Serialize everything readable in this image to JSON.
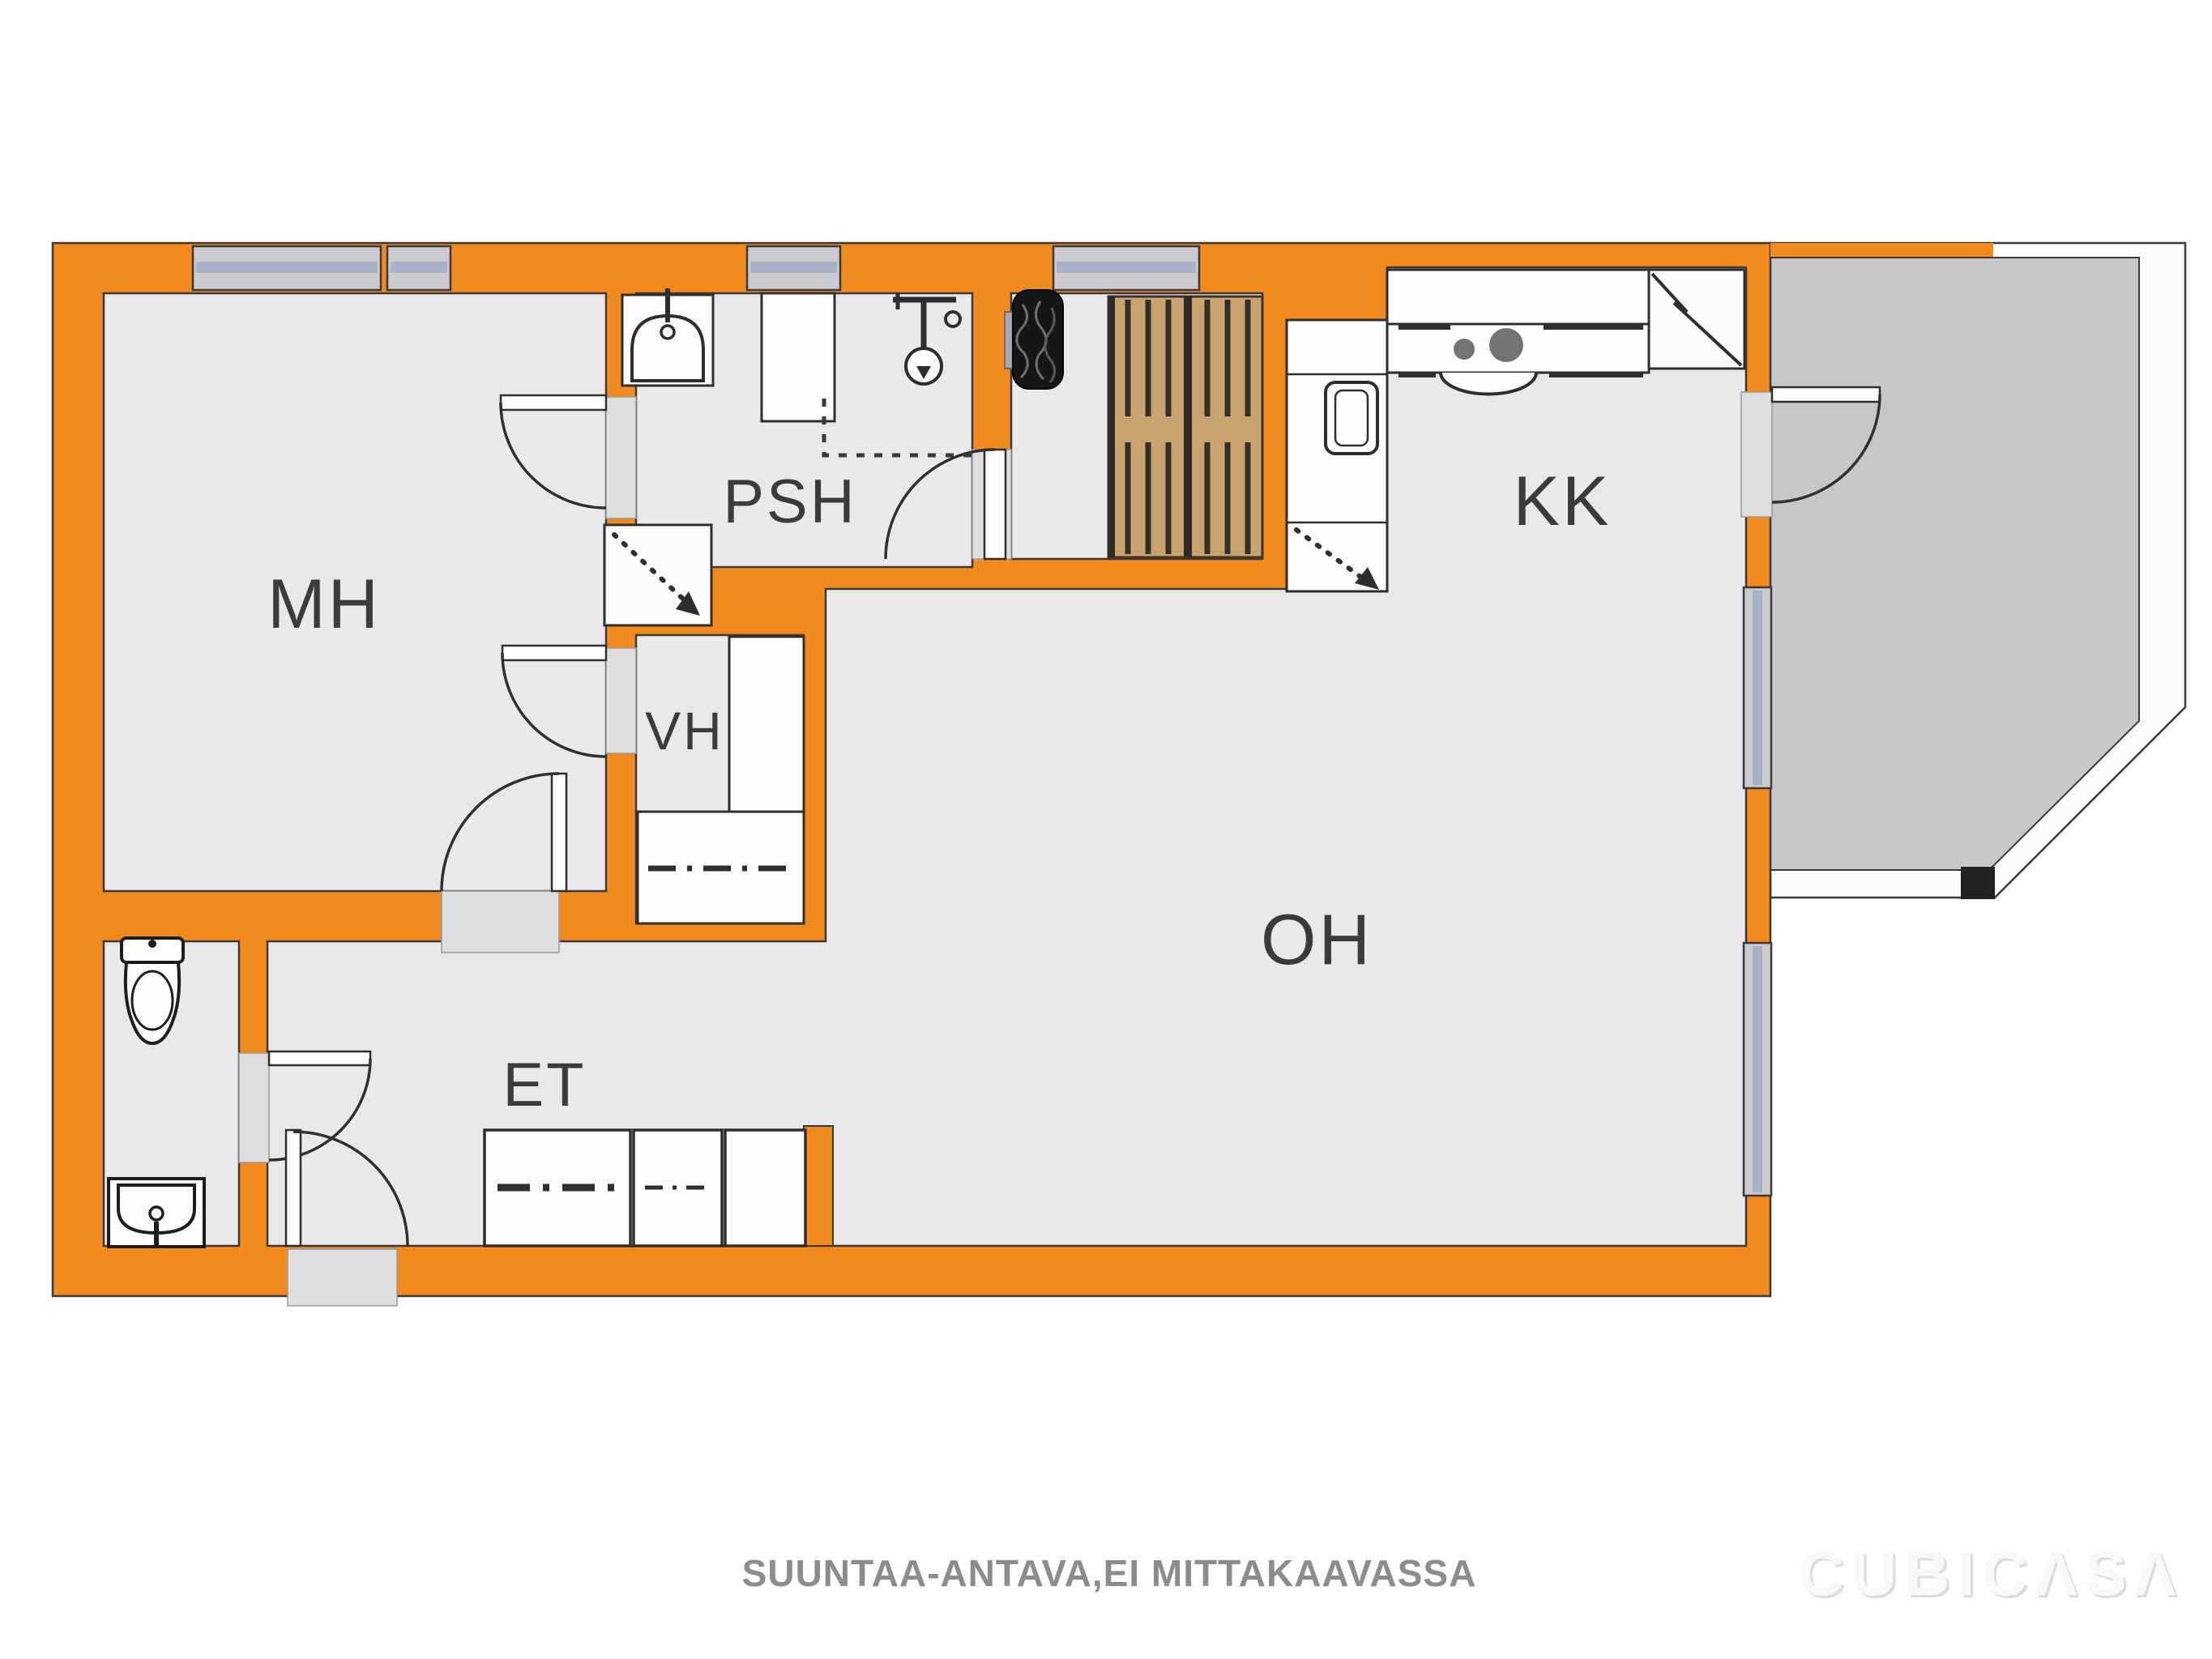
{
  "plan": {
    "rooms": {
      "mh": {
        "label": "MH"
      },
      "psh": {
        "label": "PSH"
      },
      "vh": {
        "label": "VH"
      },
      "kk": {
        "label": "KK"
      },
      "oh": {
        "label": "OH"
      },
      "et": {
        "label": "ET"
      }
    }
  },
  "footer": {
    "disclaimer": "SUUNTAA-ANTAVA,EI MITTAKAAVASSA"
  },
  "branding": {
    "logo_text": "CUBICΛSΛ"
  },
  "icons": {
    "toilet": "toilet-icon",
    "sink": "sink-icon",
    "shower": "shower-icon",
    "sauna_stove": "sauna-stove-icon",
    "stove_burners": "stove-burners-icon",
    "fridge": "fridge-zigzag-icon",
    "oven": "oven-icon",
    "wardrobe": "wardrobe-dashdot-icon"
  },
  "colors": {
    "wall_orange": "#F28A1E",
    "floor": "#E9E8EB",
    "balcony_floor": "#C7C7C9",
    "window_frame": "#CBCBCF",
    "window_glass": "#A8B2C8",
    "wood_bench": "#C9A36E",
    "outline": "#3A3A3A",
    "label_text": "#3B3B3D",
    "disclaimer_text": "#8C8C8E"
  }
}
